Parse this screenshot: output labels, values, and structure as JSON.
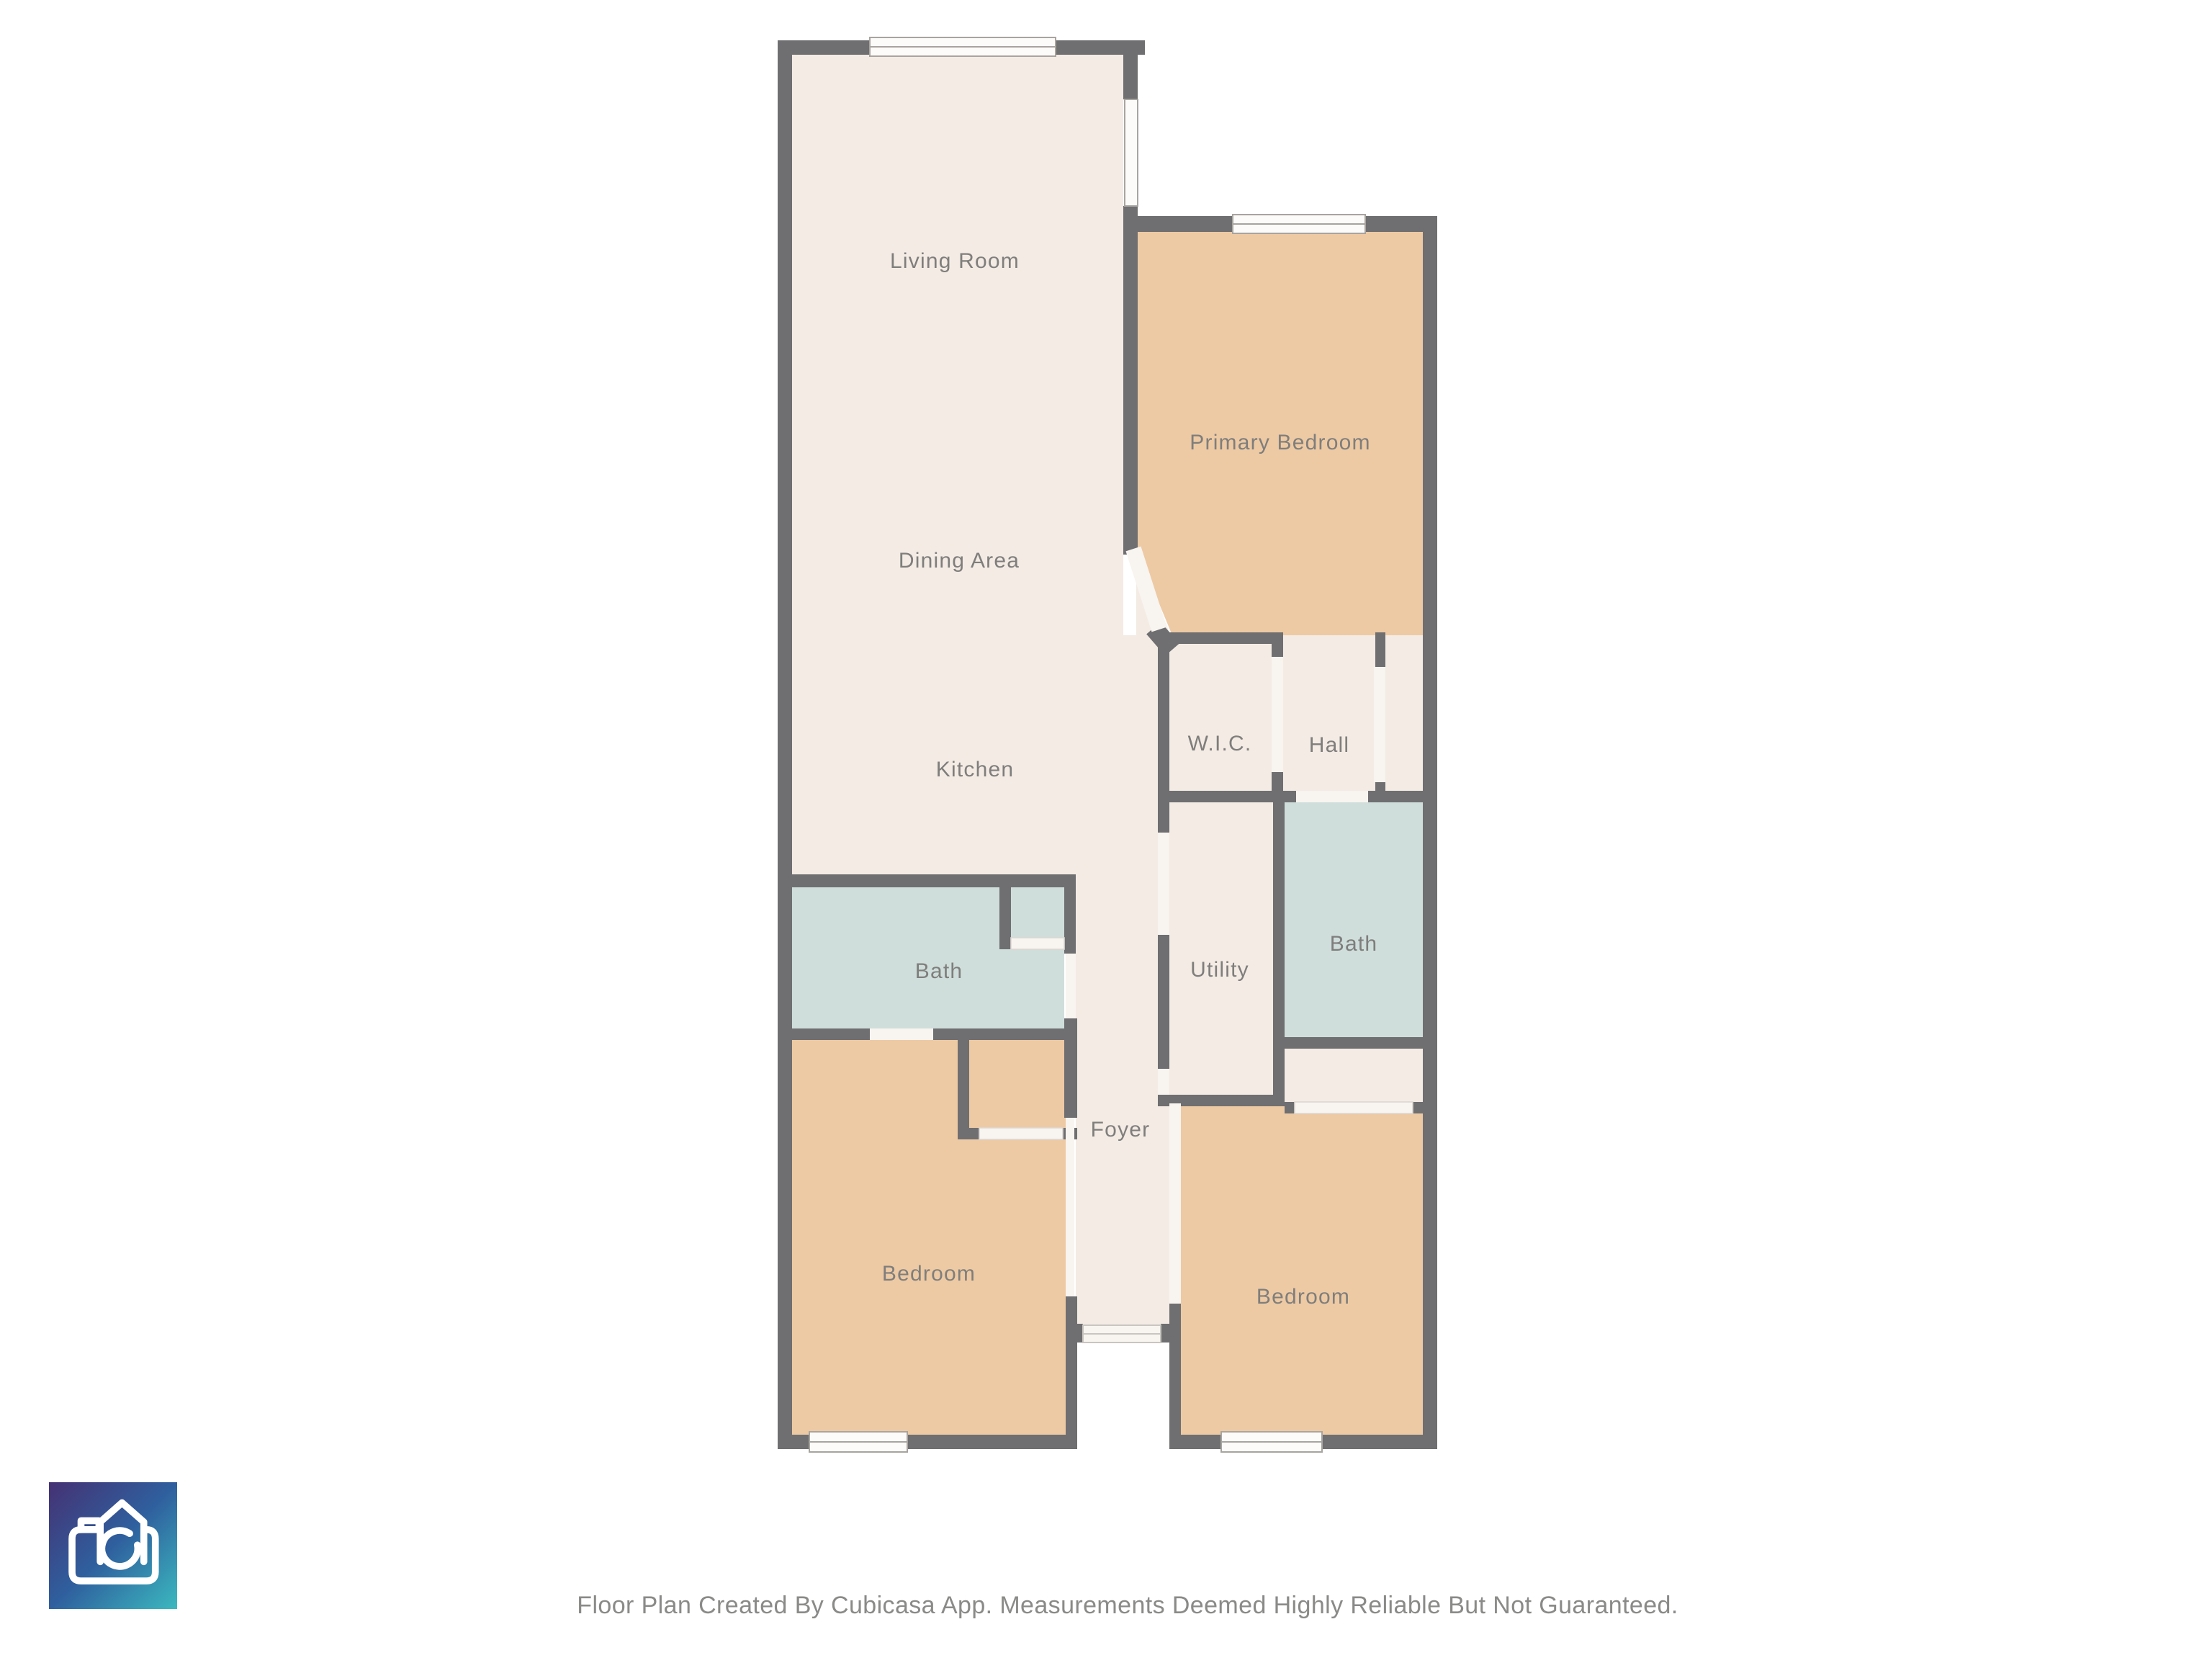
{
  "colors": {
    "wall": "#6f6f71",
    "floor_cream": "#f3ebe4",
    "floor_bedroom": "#edcaa4",
    "floor_bath": "#cfdedb",
    "door_strip": "#f8f4f0",
    "window_fill": "#fcfbfa",
    "window_stroke": "#a8a4a0",
    "label": "#7f7e7c",
    "footer_text": "#8a8a88",
    "logo_gradient_start": "#453173",
    "logo_gradient_mid": "#2f5f9e",
    "logo_gradient_end": "#3bb9bf",
    "logo_glyph": "#ffffff"
  },
  "floor_plan": {
    "rooms": [
      {
        "id": "living-room",
        "label": "Living Room"
      },
      {
        "id": "dining-area",
        "label": "Dining Area"
      },
      {
        "id": "kitchen",
        "label": "Kitchen"
      },
      {
        "id": "primary-bedroom",
        "label": "Primary Bedroom"
      },
      {
        "id": "wic",
        "label": "W.I.C."
      },
      {
        "id": "hall",
        "label": "Hall"
      },
      {
        "id": "bath-left",
        "label": "Bath"
      },
      {
        "id": "utility",
        "label": "Utility"
      },
      {
        "id": "bath-right",
        "label": "Bath"
      },
      {
        "id": "foyer",
        "label": "Foyer"
      },
      {
        "id": "bedroom-left",
        "label": "Bedroom"
      },
      {
        "id": "bedroom-right",
        "label": "Bedroom"
      }
    ]
  },
  "branding": {
    "logo_icon": "cubicasa-camera-icon"
  },
  "footer": {
    "text": "Floor Plan Created By Cubicasa App. Measurements Deemed Highly Reliable But Not Guaranteed."
  }
}
